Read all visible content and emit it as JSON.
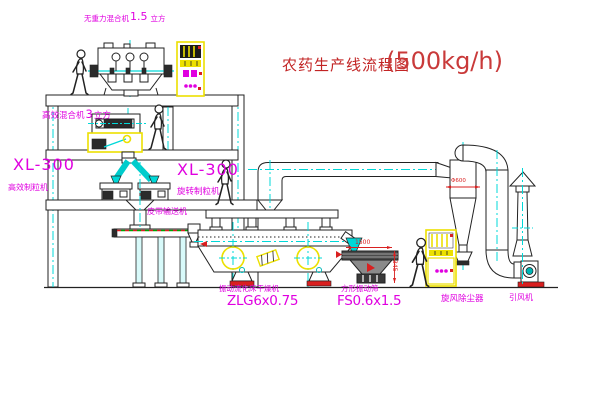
{
  "title": {
    "text": "农药生产线流程图",
    "capacity": "(500kg/h)"
  },
  "labels": {
    "no_gravity_mixer": {
      "name": "无重力混合机",
      "num": "1.5",
      "unit": "立方"
    },
    "mixer": {
      "name": "高效混合机",
      "num": "3",
      "unit": "立方"
    },
    "granulator_left": {
      "model": "XL-300",
      "name": "高效制粒机"
    },
    "granulator_mid": {
      "model": "XL-300",
      "name": "旋转制粒机"
    },
    "belt_conveyor": "皮带输送机",
    "dryer": {
      "name": "振动流化床干燥机",
      "model": "ZLG6x0.75"
    },
    "screen": {
      "name": "方形振动筛",
      "model": "FS0.6x1.5"
    },
    "cyclone": "旋风除尘器",
    "fan": "引风机"
  },
  "dimensions": {
    "screen_length": "1500",
    "screen_outlet_height": "345",
    "cyclone_diameter": "Φ600"
  },
  "colors": {
    "label_magenta": "#e000e0",
    "title_red": "#c22424",
    "dim_red": "#d92020",
    "line_yellow": "#ece000",
    "centerline_cyan": "#00d8d8",
    "drawing_black": "#222222"
  }
}
